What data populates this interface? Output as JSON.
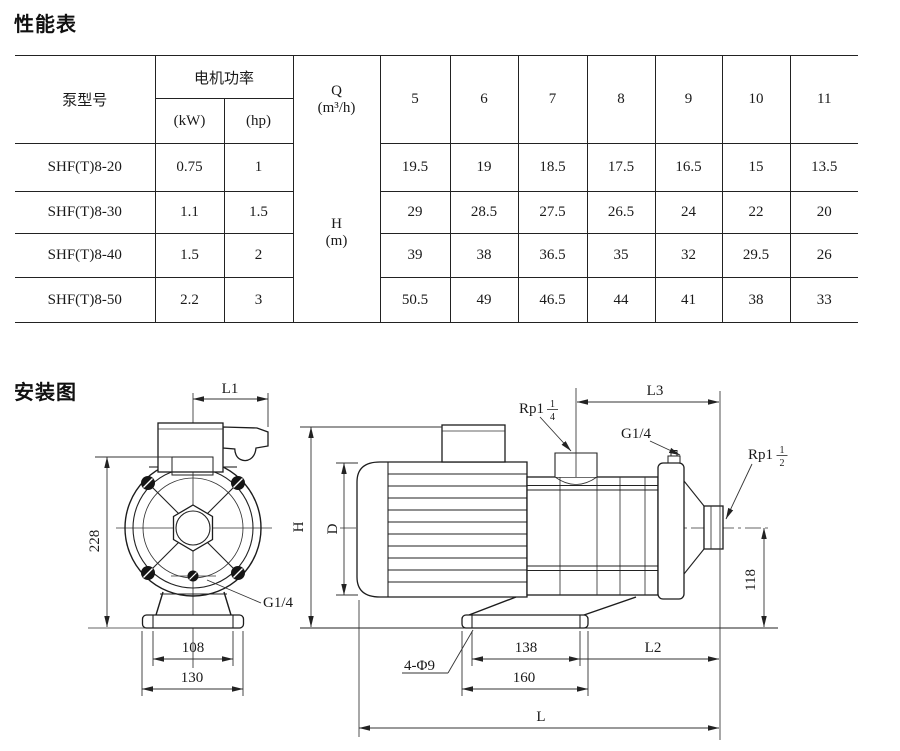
{
  "titles": {
    "performance": "性能表",
    "installation": "安装图"
  },
  "table": {
    "pump_model_header": "泵型号",
    "motor_power_header": "电机功率",
    "kw_header": "(kW)",
    "hp_header": "(hp)",
    "q_line1": "Q",
    "q_line2": "(m³/h)",
    "h_line1": "H",
    "h_line2": "(m)",
    "flow_cols": [
      "5",
      "6",
      "7",
      "8",
      "9",
      "10",
      "11"
    ],
    "rows": [
      {
        "model": "SHF(T)8-20",
        "kw": "0.75",
        "hp": "1",
        "heads": [
          "19.5",
          "19",
          "18.5",
          "17.5",
          "16.5",
          "15",
          "13.5"
        ]
      },
      {
        "model": "SHF(T)8-30",
        "kw": "1.1",
        "hp": "1.5",
        "heads": [
          "29",
          "28.5",
          "27.5",
          "26.5",
          "24",
          "22",
          "20"
        ]
      },
      {
        "model": "SHF(T)8-40",
        "kw": "1.5",
        "hp": "2",
        "heads": [
          "39",
          "38",
          "36.5",
          "35",
          "32",
          "29.5",
          "26"
        ]
      },
      {
        "model": "SHF(T)8-50",
        "kw": "2.2",
        "hp": "3",
        "heads": [
          "50.5",
          "49",
          "46.5",
          "44",
          "41",
          "38",
          "33"
        ]
      }
    ]
  },
  "diagram": {
    "front": {
      "l1": "L1",
      "d228": "228",
      "d108": "108",
      "d130": "130",
      "g14": "G1/4"
    },
    "side": {
      "l3": "L3",
      "l2": "L2",
      "l": "L",
      "h": "H",
      "d": "D",
      "d118": "118",
      "d138": "138",
      "d160": "160",
      "g14": "G1/4",
      "holes": "4-Φ9",
      "rp114_prefix": "Rp1",
      "rp114_num": "1",
      "rp114_den": "4",
      "rp112_prefix": "Rp1",
      "rp112_num": "1",
      "rp112_den": "2"
    }
  }
}
